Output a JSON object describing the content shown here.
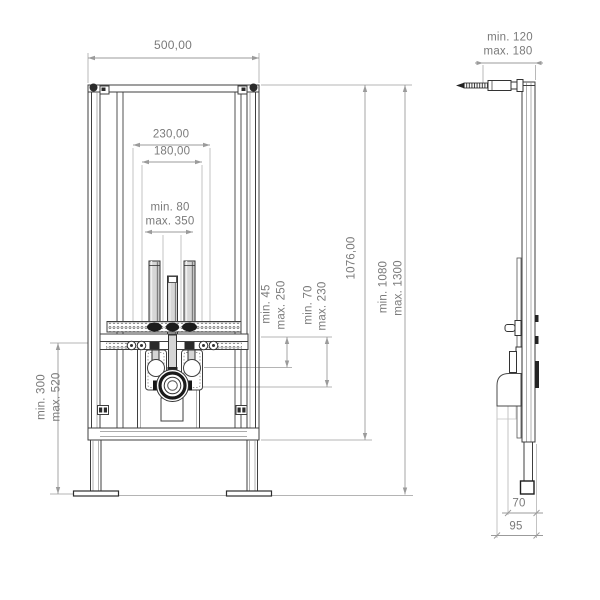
{
  "front_view": {
    "frame_width": "500,00",
    "rail_width": "230,00",
    "fixing_width": "180,00",
    "rod_projection_min": "min. 80",
    "rod_projection_max": "max. 350",
    "fixing_drop_min": "min. 45",
    "fixing_drop_max": "max. 250",
    "drain_drop_min": "min. 70",
    "drain_drop_max": "max. 230",
    "frame_height": "1076,00",
    "install_height_min": "min. 1080",
    "install_height_max": "max. 1300",
    "leg_extension_min": "min. 300",
    "leg_extension_max": "max. 520"
  },
  "side_view": {
    "rod_projection_min": "min. 120",
    "rod_projection_max": "max. 180",
    "drain_offset": "70",
    "drain_pipe_offset": "95"
  },
  "colors": {
    "linework": "#3f3f3f",
    "dimension_lines": "#9b9b9b",
    "dimension_text": "#7a7a7a",
    "background": "#ffffff"
  }
}
